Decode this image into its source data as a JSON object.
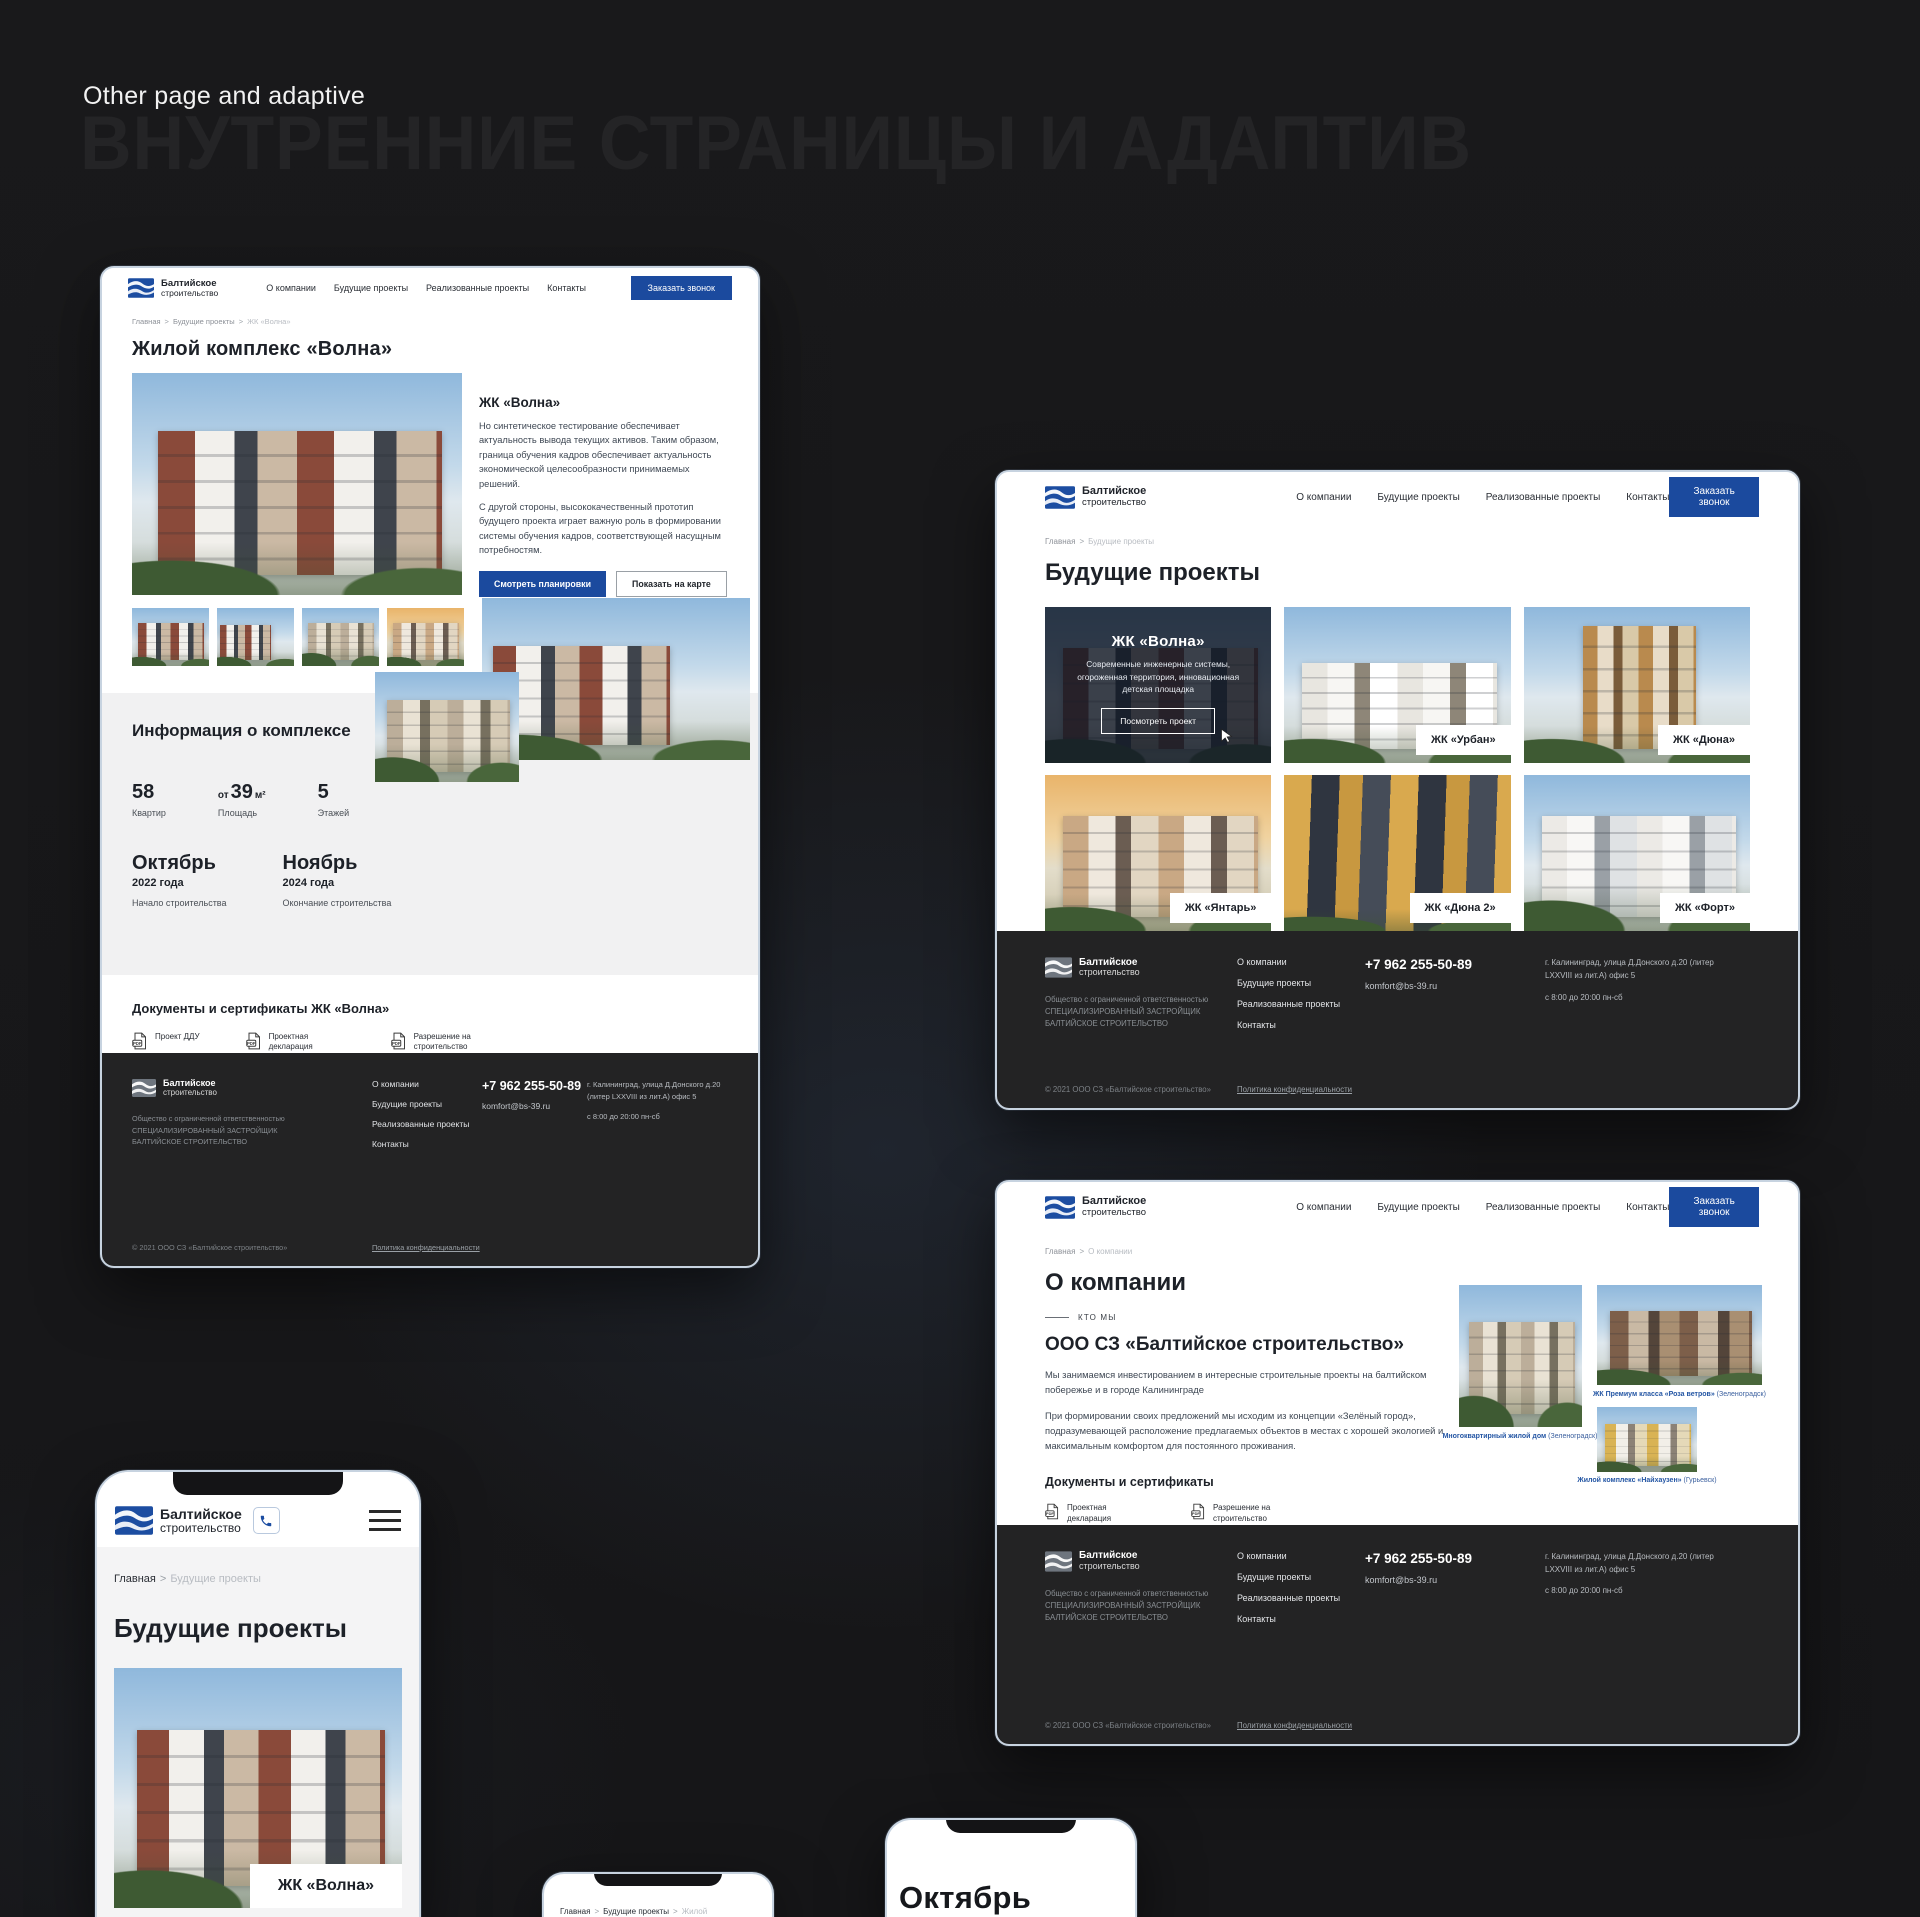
{
  "page": {
    "title": "Other page and adaptive",
    "watermark": "ВНУТРЕННИЕ СТРАНИЦЫ И АДАПТИВ",
    "accent_color": "#1b4a9e",
    "footer_color": "#232324"
  },
  "site": {
    "logo_line1": "Балтийское",
    "logo_line2": "строительство",
    "nav": [
      "О компании",
      "Будущие проекты",
      "Реализованные проекты",
      "Контакты"
    ],
    "call_button": "Заказать звонок",
    "crumb_sep": ">",
    "footer": {
      "legal": "Общество с ограниченной ответственностью СПЕЦИАЛИЗИРОВАННЫЙ ЗАСТРОЙЩИК БАЛТИЙСКОЕ СТРОИТЕЛЬСТВО",
      "links": [
        "О компании",
        "Будущие проекты",
        "Реализованные проекты",
        "Контакты"
      ],
      "phone": "+7 962 255-50-89",
      "email": "komfort@bs-39.ru",
      "address": "г. Калининград, улица Д.Донского д.20 (литер LXXVIII из лит.А) офис 5",
      "hours": "с 8:00 до 20:00 пн-сб",
      "copyright": "© 2021 ООО СЗ «Балтийское строительство»",
      "privacy": "Политика конфиденциальности"
    }
  },
  "volna_page": {
    "breadcrumb": [
      "Главная",
      "Будущие проекты",
      "ЖК «Волна»"
    ],
    "title": "Жилой комплекс «Волна»",
    "hero": {
      "heading": "ЖК «Волна»",
      "paragraph1": "Но синтетическое тестирование обеспечивает актуальность вывода текущих активов. Таким образом, граница обучения кадров обеспечивает актуальность экономической целесообразности принимаемых решений.",
      "paragraph2": "С другой стороны, высококачественный прототип будущего проекта играет важную роль в формировании системы обучения кадров, соответствующей насущным потребностям.",
      "primary_button": "Смотреть планировки",
      "secondary_button": "Показать на карте"
    },
    "info": {
      "title": "Информация о комплексе",
      "stats": [
        {
          "value": "58",
          "label": "Квартир"
        },
        {
          "prefix": "от",
          "value": "39",
          "unit": "м²",
          "label": "Площадь"
        },
        {
          "value": "5",
          "label": "Этажей"
        }
      ],
      "timeline": [
        {
          "month": "Октябрь",
          "year": "2022 года",
          "label": "Начало строительства"
        },
        {
          "month": "Ноябрь",
          "year": "2024 года",
          "label": "Окончание строительства"
        }
      ]
    },
    "docs": {
      "title": "Документы и сертификаты ЖК «Волна»",
      "items": [
        "Проект ДДУ",
        "Проектная декларация",
        "Разрешение на строительство"
      ]
    }
  },
  "projects_page": {
    "breadcrumb": [
      "Главная",
      "Будущие проекты"
    ],
    "title": "Будущие проекты",
    "active_card": {
      "name": "ЖК «Волна»",
      "description": "Современные инженерные системы, огороженная территория, инновационная детская площадка",
      "button": "Посмотреть проект"
    },
    "cards": [
      "ЖК «Урбан»",
      "ЖК «Дюна»",
      "ЖК «Янтарь»",
      "ЖК «Дюна 2»",
      "ЖК «Форт»"
    ]
  },
  "about_page": {
    "breadcrumb": [
      "Главная",
      "О компании"
    ],
    "title": "О компании",
    "kicker": "КТО МЫ",
    "heading": "ООО СЗ «Балтийское строительство»",
    "paragraph1": "Мы занимаемся инвестированием в интересные строительные проекты на балтийском побережье и в городе Калининграде",
    "paragraph2": "При формировании своих предложений мы исходим из концепции «Зелёный город», подразумевающей расположение предлагаемых объектов в местах с хорошей экологией и максимальным комфортом для постоянного проживания.",
    "docs": {
      "title": "Документы и сертификаты",
      "items": [
        "Проектная декларация",
        "Разрешение на строительство"
      ]
    },
    "gallery": [
      {
        "caption": "Многоквартирный жилой дом",
        "location": "(Зеленоградск)"
      },
      {
        "caption": "ЖК Премиум класса «Роза ветров»",
        "location": "(Зеленоградск)"
      },
      {
        "caption": "Жилой комплекс «Найхаузен»",
        "location": "(Гурьевск)"
      }
    ]
  },
  "mobile": {
    "breadcrumb": [
      "Главная",
      "Будущие проекты"
    ],
    "title": "Будущие проекты",
    "card_label": "ЖК «Волна»"
  },
  "partials": {
    "breadcrumb": [
      "Главная",
      "Будущие проекты",
      "Жилой"
    ],
    "month": "Октябрь"
  }
}
